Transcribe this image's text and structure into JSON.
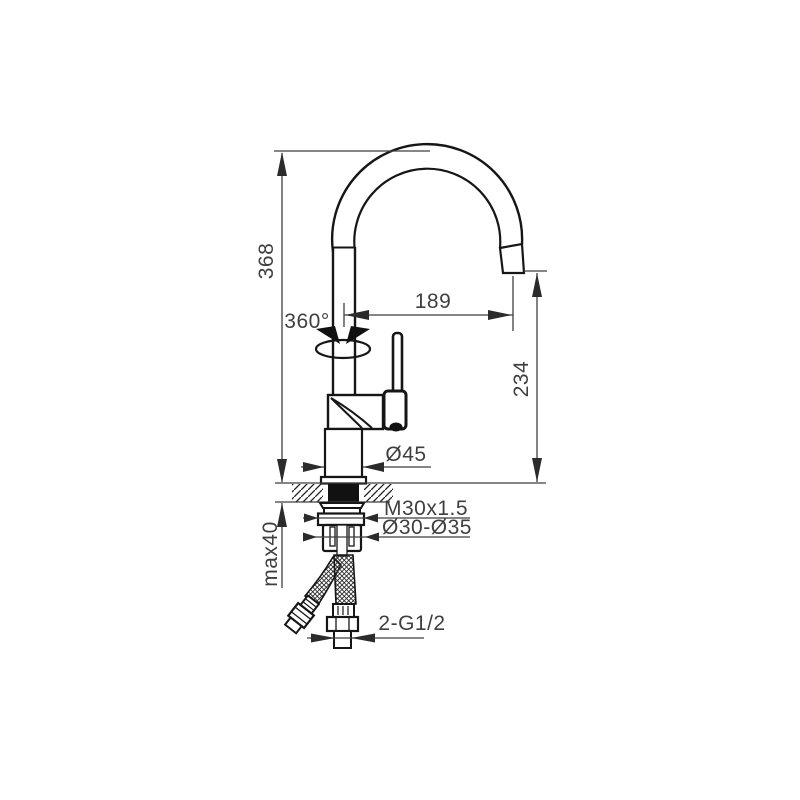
{
  "title": "Kitchen faucet installation drawing",
  "labels": {
    "total_height": "368",
    "swivel_angle": "360°",
    "spout_reach": "189",
    "outlet_height": "234",
    "body_diameter": "Ø45",
    "fixing_thread": "M30x1.5",
    "mounting_hole": "Ø30-Ø35",
    "max_deck_thickness": "max40",
    "hose_thread": "2-G1/2"
  },
  "colors": {
    "outline": "#161616",
    "dimension": "#3f3f3f",
    "background": "#ffffff"
  }
}
